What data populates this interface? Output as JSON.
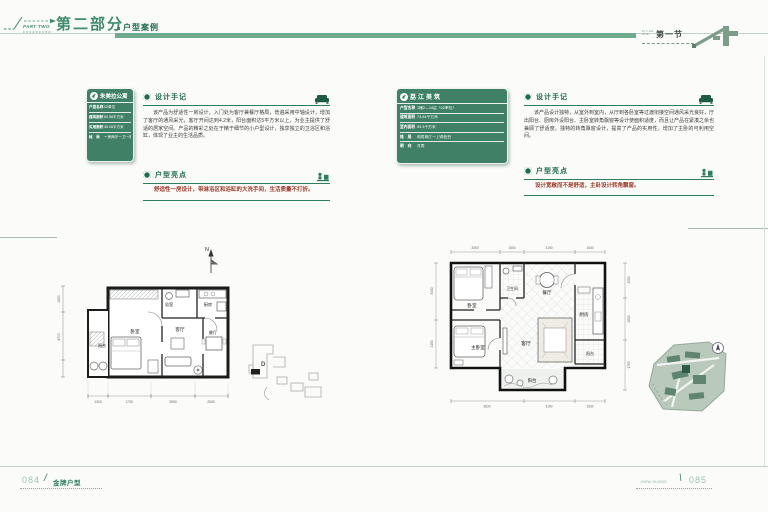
{
  "header": {
    "part_label": "PART TWO",
    "part_title": "第二部分",
    "part_subtitle": "户型案例",
    "section_small_1": "DIYIJIE",
    "section_small_2": "ONE",
    "section_title": "第一节"
  },
  "left_unit": {
    "info": {
      "title": "朱美拉公寓",
      "rows": [
        {
          "label": "户型名称",
          "value": "02单位"
        },
        {
          "label": "建筑面积",
          "value": "60.58平方米"
        },
        {
          "label": "实用面积",
          "value": "45.08平方米"
        },
        {
          "label": "格　局",
          "value": "一房两厅一卫一阳台"
        }
      ]
    },
    "notes": {
      "title": "设计手记",
      "body": "该产品为舒适性一房设计，入门处为客厅兼餐厅格局，普遍采用中轴设计，增加了客厅的通风采光，客厅开间达到4.2米，阳台面积达5平方米以上，为业主提供了舒适的居家空间。产品的精彩之处在于精于细节的小户型设计，独享独立的卫浴区和浴缸，体现了业主的生活品质。"
    },
    "highlights": {
      "title": "户型亮点",
      "body": "舒适性一房设计，带淋浴区和浴缸的大洗手间，生活质量不打折。"
    },
    "plan": {
      "north": "N",
      "site_marker": "D",
      "rooms": {
        "balcony": "阳台",
        "bedroom": "卧室",
        "bath": "浴室",
        "kitchen": "厨房",
        "living": "客厅",
        "dining": "餐厅"
      },
      "dims_bottom": [
        "1300",
        "1730",
        "3990",
        "2530"
      ],
      "dims_left": [
        "1650",
        "4700"
      ]
    }
  },
  "right_unit": {
    "info": {
      "title": "荔江美筑",
      "rows": [
        {
          "label": "户型名称",
          "value": "1幢2—14层（02单位）"
        },
        {
          "label": "建筑面积",
          "value": "73.64平方米"
        },
        {
          "label": "室内面积",
          "value": "59.3平方米"
        },
        {
          "label": "格　局",
          "value": "两房两厅一卫两阳台"
        },
        {
          "label": "朝　向",
          "value": "东南"
        }
      ]
    },
    "notes": {
      "title": "设计手记",
      "body": "该产品设计独特，从室外到室内，从厅到各卧室等过渡衔接空间通风采光良好，厅出阳台、厨房外设阳台、主卧室转角飘窗等设计使面积适度，而且让产品在紧凑之余也兼顾了舒适度。独特的转角飘窗设计，提高了产品的实用性，增加了主卧的可利用空间。"
    },
    "highlights": {
      "title": "户型亮点",
      "body": "设计宽敞而不是舒适，主卧设计转角飘窗。"
    },
    "plan": {
      "rooms": {
        "bedroom": "卧室",
        "bath": "卫生间",
        "dining": "餐厅",
        "kitchen": "厨房",
        "master": "主卧室",
        "living": "客厅",
        "balcony_south": "阳台",
        "balcony_east": "阳台"
      },
      "dims_top": [
        "3300",
        "1500",
        "3190",
        "1530"
      ],
      "dims_bottom": [
        "3630",
        "3190",
        "1530"
      ],
      "dims_left": [
        "3400",
        "2150"
      ],
      "dims_right": [
        "1500",
        "2600",
        "1750"
      ]
    }
  },
  "footer": {
    "left_page": "084",
    "left_slash": "/",
    "left_label": "金牌户型",
    "right_label": "JINPAI HUXING",
    "right_slash": "\\",
    "right_page": "085"
  },
  "colors": {
    "accent_green": "#3f8b6d",
    "dark_green": "#1f6b50",
    "box_green": "#3f8066",
    "bar_green": "#6fa98e",
    "highlight_red": "#9c3a28"
  },
  "icons": {
    "header": "house-icon",
    "notes": "sofa-icon",
    "highlights": "furniture-icon",
    "north": "north-arrow-icon",
    "compass": "compass-icon",
    "logo": "developer-logo-icon"
  }
}
